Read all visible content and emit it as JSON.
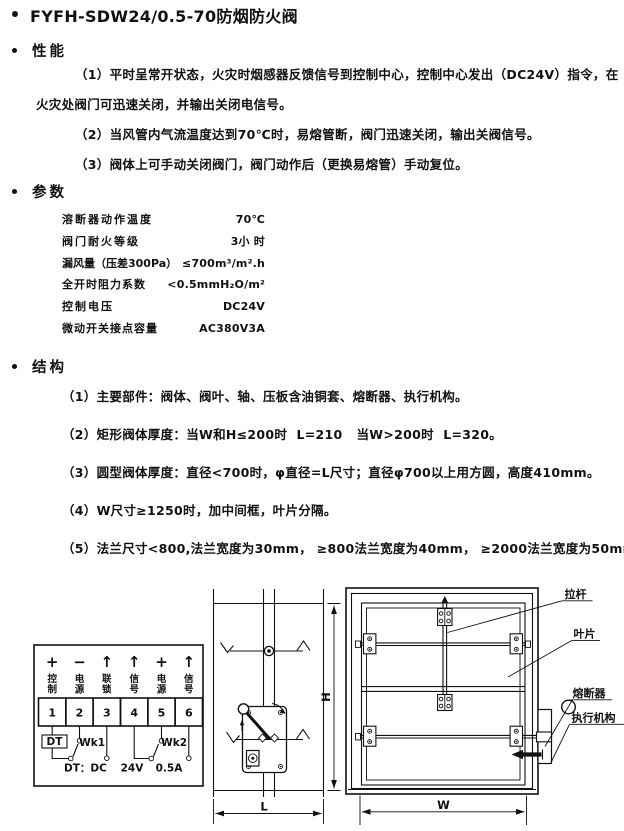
{
  "colors": {
    "ink": "#111111",
    "paper": "#ffffff"
  },
  "title": "FYFH-SDW24/0.5-70防烟防火阀",
  "performance": {
    "heading": "性能",
    "lines": [
      "（1）平时呈常开状态，火灾时烟感器反馈信号到控制中心，控制中心发出（DC24V）指令，在",
      "火灾处阀门可迅速关闭，并输出关闭电信号。",
      "（2）当风管内气流温度达到70℃时，易熔管断，阀门迅速关闭，输出关阀信号。",
      "（3）阀体上可手动关闭阀门，阀门动作后（更换易熔管）手动复位。"
    ]
  },
  "parameters": {
    "heading": "参数",
    "rows": [
      {
        "label": "溶断器动作温度",
        "value": "70℃"
      },
      {
        "label": "阀门耐火等级",
        "value": "3小 时"
      },
      {
        "label": "漏风量（压差300Pa）",
        "value": "≤700m³/m².h"
      },
      {
        "label": "全开时阻力系数",
        "value": "<0.5mmH₂O/m²"
      },
      {
        "label": "控制电压",
        "value": "DC24V"
      },
      {
        "label": "微动开关接点容量",
        "value": "AC380V3A"
      }
    ]
  },
  "structure": {
    "heading": "结构",
    "items": [
      "（1）主要部件：阀体、阀叶、轴、压板含油铜套、熔断器、执行机构。",
      "（2）矩形阀体厚度：当W和H≤200时  L=210   当W>200时  L=320。",
      "（3）圆型阀体厚度：直径<700时，φ直径=L尺寸；直径φ700以上用方圆，高度410mm。",
      "（4）W尺寸≥1250时，加中间框，叶片分隔。",
      "（5）法兰尺寸<800,法兰宽度为30mm， ≥800法兰宽度为40mm， ≥2000法兰宽度为50mm。"
    ]
  },
  "terminal_diagram": {
    "terminals": [
      {
        "symbol": "+",
        "label": "控制",
        "number": "1"
      },
      {
        "symbol": "−",
        "label": "电源",
        "number": "2"
      },
      {
        "symbol": "↑",
        "label": "联锁",
        "number": "3"
      },
      {
        "symbol": "↑",
        "label": "信号",
        "number": "4"
      },
      {
        "symbol": "+",
        "label": "电源",
        "number": "5"
      },
      {
        "symbol": "↑",
        "label": "信号",
        "number": "6"
      }
    ],
    "dt_box": "DT",
    "wk1": "Wk1",
    "wk2": "Wk2",
    "note_dt": "DT：DC",
    "note_voltage": "24V",
    "note_current": "0.5A"
  },
  "side_view": {
    "dim_depth": "L",
    "dim_height": "H"
  },
  "front_view": {
    "dim_width": "W",
    "label_pull_rod": "拉杆",
    "label_blade": "叶片",
    "label_fuse": "熔断器",
    "label_actuator": "执行机构"
  }
}
